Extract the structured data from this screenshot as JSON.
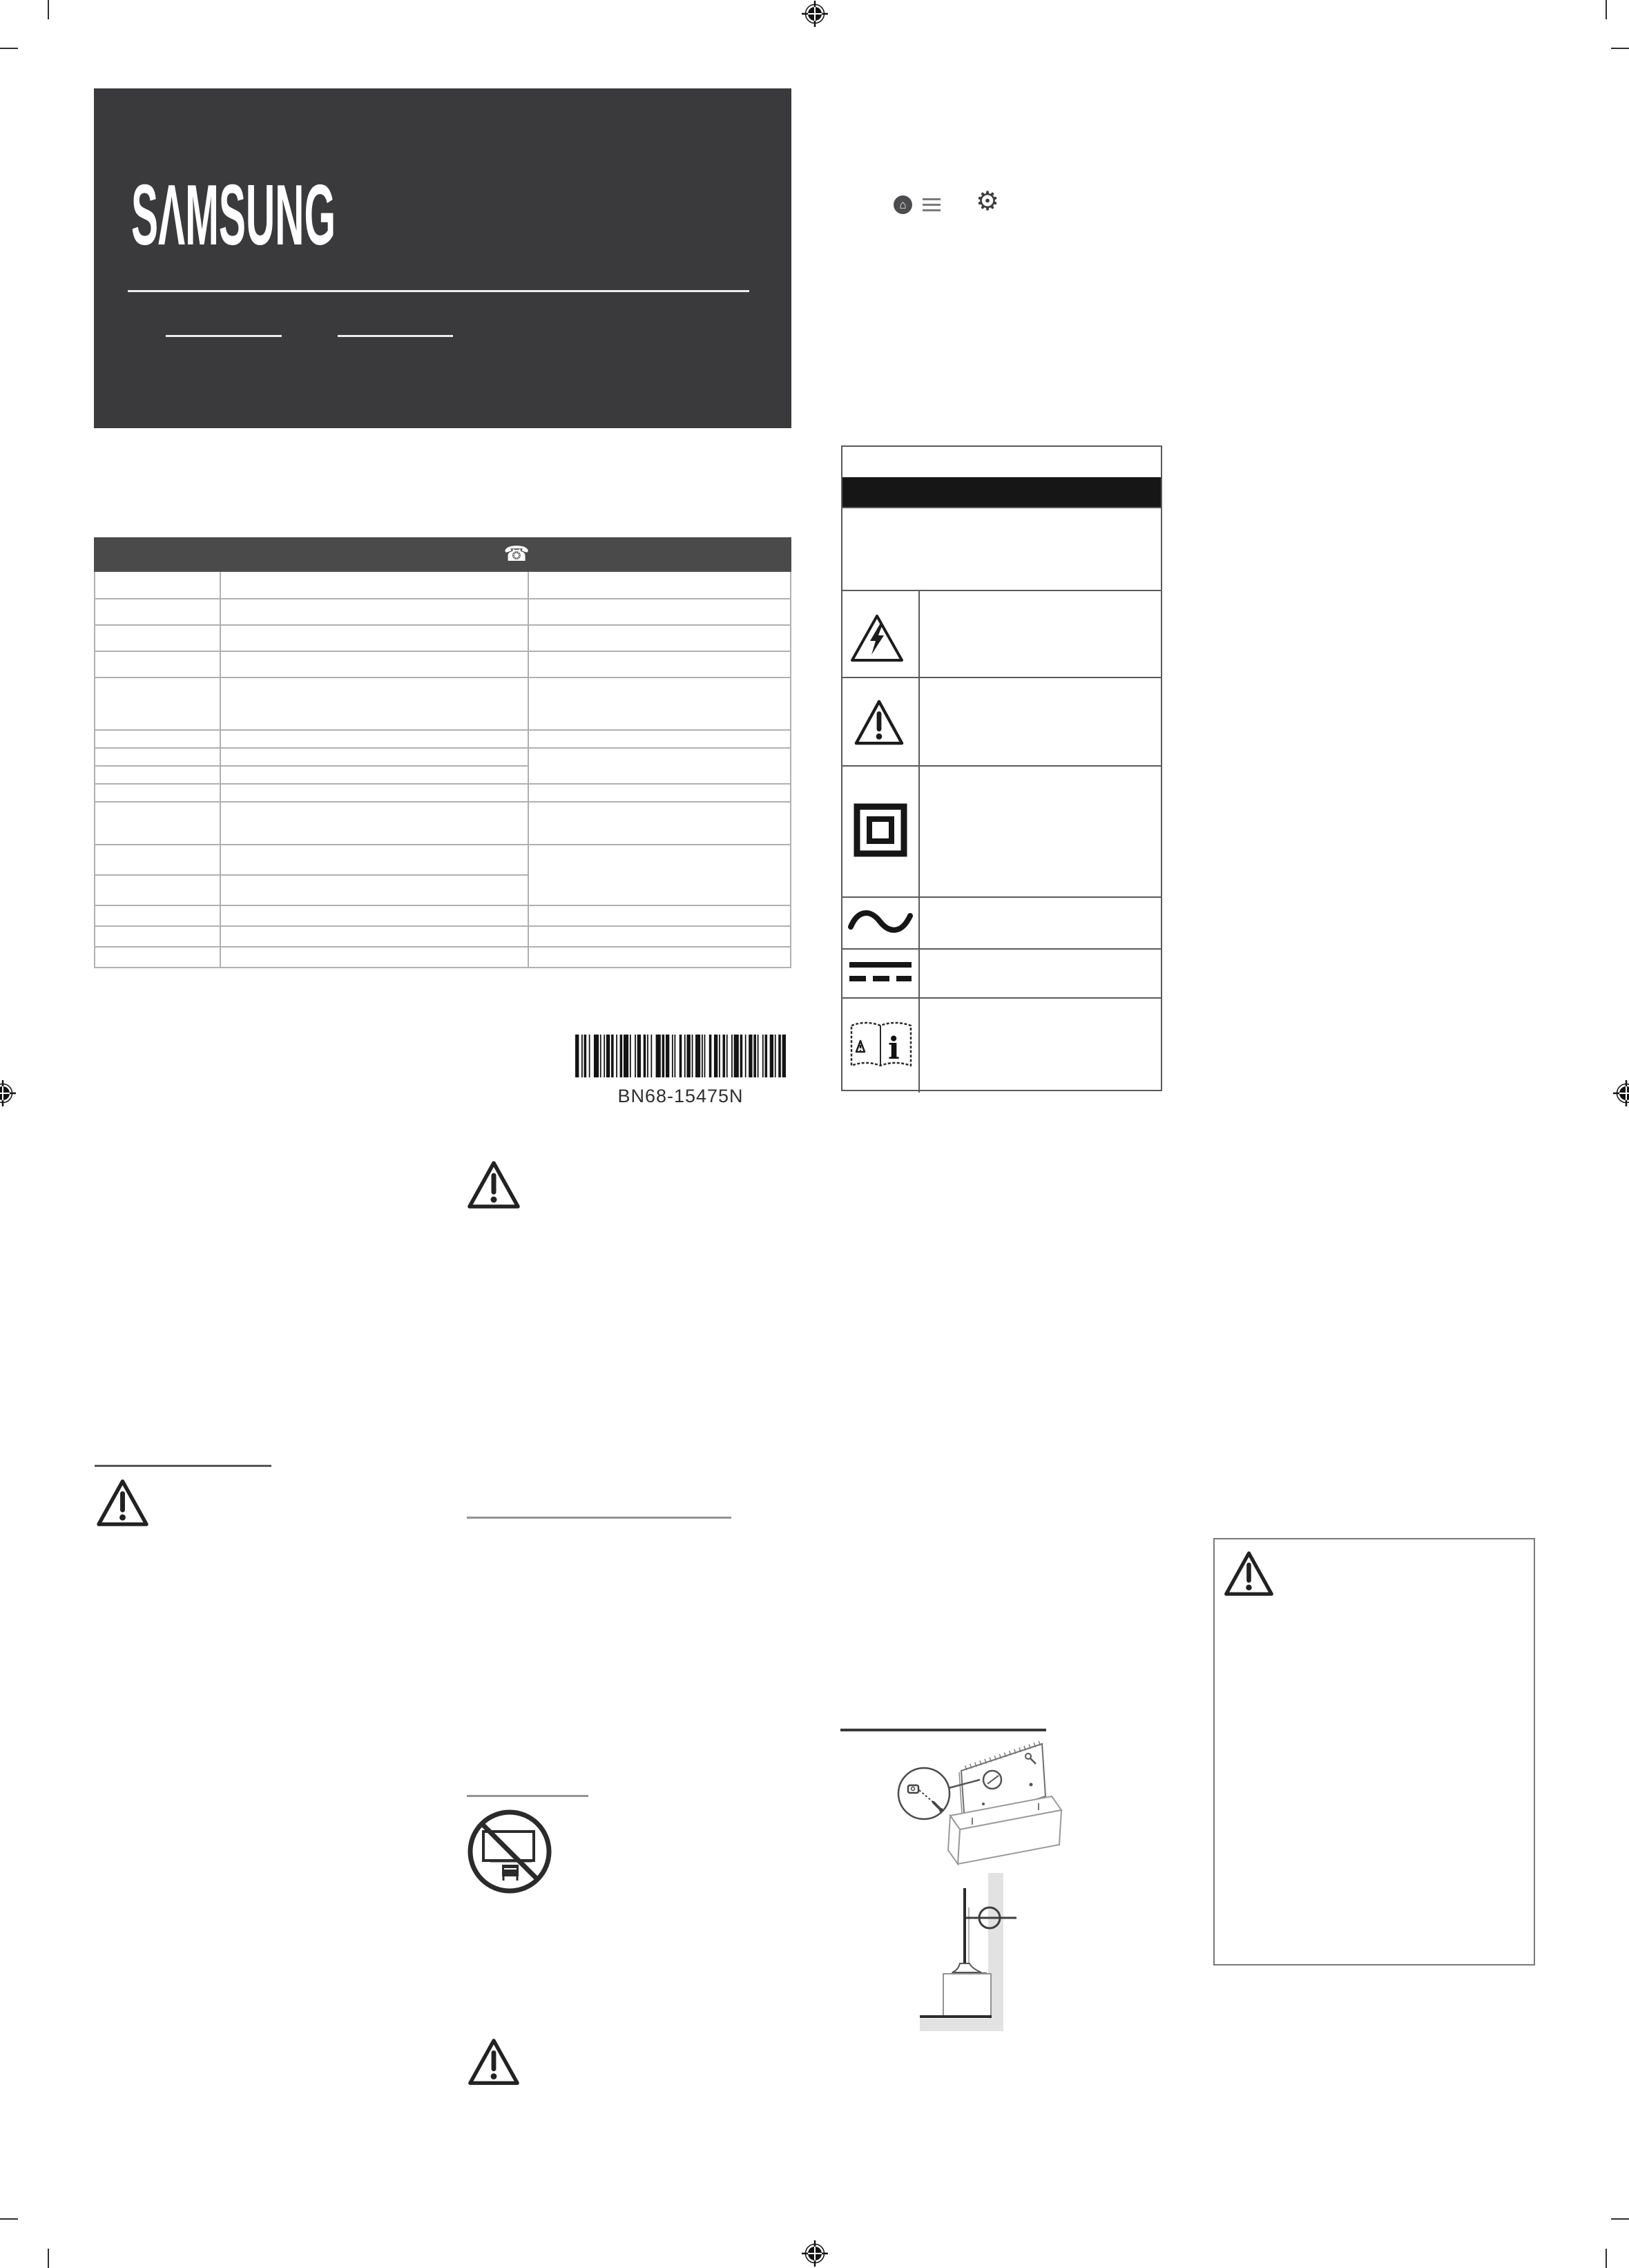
{
  "page": {
    "part_number": "BN68-15475N"
  },
  "brand": {
    "name": "SAMSUNG",
    "logo_display": "SΛMSUNG"
  },
  "barcode": {
    "label": "BN68-15475N"
  },
  "header_icons": {
    "home_glyph": "⌂",
    "gear_glyph": "⚙"
  },
  "contact_table": {
    "header_phone_glyph": "☎"
  },
  "symbol_table": {
    "rows": [
      {
        "name": "title-row"
      },
      {
        "name": "black-banner-row"
      },
      {
        "name": "text-row"
      },
      {
        "name": "high-voltage-warning"
      },
      {
        "name": "caution-warning"
      },
      {
        "name": "class-ii-equipment"
      },
      {
        "name": "ac-voltage"
      },
      {
        "name": "dc-voltage"
      },
      {
        "name": "refer-to-manual",
        "info_glyph": "i"
      }
    ]
  },
  "colors": {
    "panel_dark": "#3a3a3c",
    "table_header_dark": "#4a4a4b",
    "banner_black": "#161616",
    "grid_gray": "#b0b0b0",
    "symbol_grid_gray": "#5a5a5a",
    "wall_gray": "#e2e2e2"
  }
}
